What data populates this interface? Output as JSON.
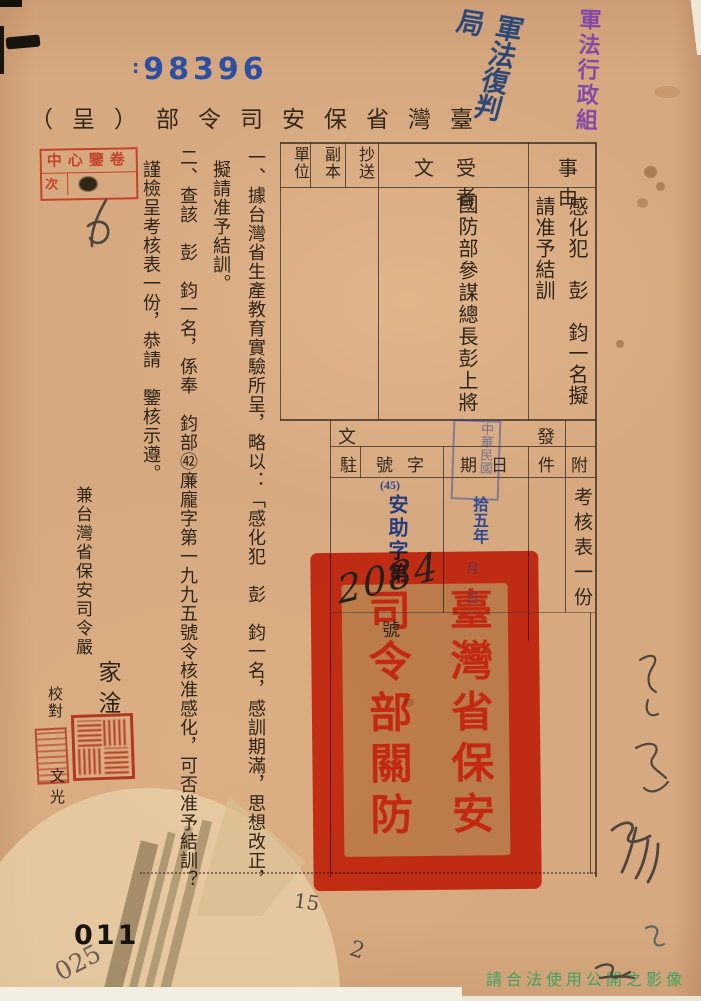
{
  "header": {
    "serial_prefix": ":",
    "serial": "98396",
    "purple_note": "軍法行政組",
    "blue_note": "軍法復判局",
    "archive_stamp_row1": "中心鑒卷",
    "archive_stamp_row2": "次",
    "title": "臺灣省保安司令部（呈）"
  },
  "form": {
    "subject_label": "事由",
    "subject_value": "感化犯　彭　鈞一名擬請准予結訓",
    "recipient_label": "受文者",
    "recipient_value": "國防部參謀總長彭上將",
    "copy_label": "抄送",
    "duplicate_label": "副本",
    "unit_label": "單位",
    "dispatch_label": "發文",
    "station_label": "駐",
    "number_label": "字號",
    "date_label": "日期",
    "attachment_label": "附",
    "attachment_sub_label": "件",
    "attachment_value": "考核表一份",
    "number_prefix": "(45)",
    "number_text": "安助字第",
    "number_handwritten": "2084",
    "number_suffix": "號",
    "date_value": "拾五年",
    "date_stamp": "中華民國"
  },
  "body": {
    "col1": "一、據台灣省生產教育實驗所呈，略以：「感化犯　彭　鈞一名，感訓期滿，思想改正，",
    "col2": "擬請准予結訓。",
    "col3": "二、查該　彭　鈞一名，係奉　鈞部㊷廉龐字第一九九五號令核准感化，可否准予結訓？",
    "col4": "謹檢呈考核表一份，恭請　鑒核示遵。"
  },
  "seal": {
    "col_right": "臺灣省保安",
    "col_left": "司令部關防"
  },
  "officials": {
    "commander_line": "兼台灣省保安司令嚴",
    "commander_name": "家淦",
    "proof_label": "校對",
    "proof_name": "文光"
  },
  "footer": {
    "page_number": "011",
    "pencil_number": "025",
    "pencil_mid": "15",
    "pencil_mark": "2",
    "copyright_note": "請合法使用公開之影像"
  },
  "colors": {
    "paper": "#d7a981",
    "ink": "#2e2417",
    "blue": "#27488f",
    "purple": "#8348a8",
    "red": "#df3a1e",
    "green": "#2ea35c",
    "pencil": "#564e44"
  }
}
